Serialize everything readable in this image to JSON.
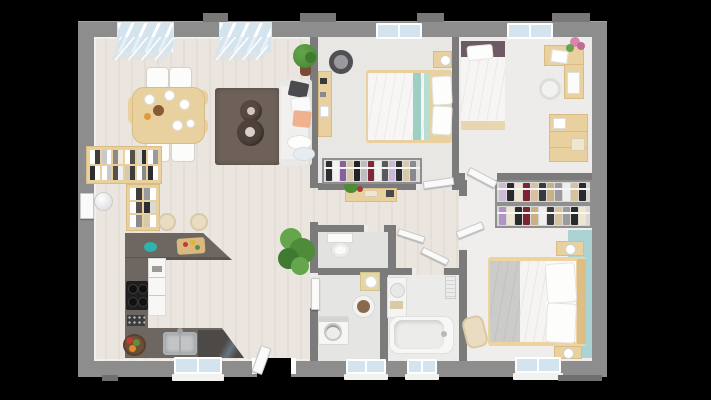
{
  "scene": {
    "type": "3d-floorplan-top-down-render",
    "background": "#000000",
    "has_text": false
  },
  "palette": {
    "wall": "#8d8d8d",
    "wall_inner": "#7b7b7b",
    "floor_a": "#eae5df",
    "floor_b": "#e4ded6",
    "b1_floor": "#e9e7e4",
    "b2_floor": "#edecea",
    "b3_floor": "#efeeec",
    "wc_floor": "#e2e2e0",
    "util_floor": "#e5e5e3",
    "bath_floor": "#ebebe9",
    "wood": "#e8d19e",
    "wood_dark": "#d9bc84",
    "counter": "#6e6660",
    "counter_dark": "#4d4946",
    "white_f": "#f7f7f5",
    "sofa": "#f1f0ee",
    "teal_wall": "#abd3d4",
    "teal_textile": "#9ecfc5",
    "rug": "#6d6159",
    "pouf": "#57493f",
    "glass": "#d3e4ee",
    "door": "#fafafa",
    "plant": "#4e8c3a",
    "plant_light": "#65a54b",
    "peach": "#efb18e",
    "mauve": "#6e5a64",
    "blanket": "#cbcbc9",
    "black_app": "#1f1f1f"
  },
  "rooms": [
    {
      "id": "living-dining-room",
      "furniture": [
        "dining-table",
        "dining-chairs",
        "area-rug",
        "round-poufs",
        "sofa",
        "potted-tree",
        "cube-bookshelf",
        "ball-floor-lamp"
      ]
    },
    {
      "id": "open-kitchen",
      "furniture": [
        "u-shaped-counter",
        "cooktop",
        "oven-column",
        "sink",
        "bar-stools",
        "cutting-board",
        "vegetable-basket"
      ]
    },
    {
      "id": "hallway",
      "furniture": [
        "console-table",
        "potted-plant"
      ]
    },
    {
      "id": "bedroom-1",
      "furniture": [
        "double-bed-teal",
        "desk",
        "round-chair",
        "nightstand-lamp",
        "open-wardrobe"
      ]
    },
    {
      "id": "bedroom-2",
      "furniture": [
        "single-bed",
        "corner-desk",
        "chair",
        "dresser",
        "flower-vase"
      ]
    },
    {
      "id": "bedroom-3",
      "furniture": [
        "double-bed",
        "two-nightstands",
        "double-clothes-rack",
        "armchair",
        "teal-accent-wall"
      ]
    },
    {
      "id": "wc",
      "furniture": [
        "toilet"
      ]
    },
    {
      "id": "utility-room",
      "furniture": [
        "washing-machine",
        "round-basin",
        "mini-vanity"
      ]
    },
    {
      "id": "bathroom",
      "furniture": [
        "bathtub",
        "vanity-unit",
        "radiator"
      ]
    }
  ],
  "openings": {
    "windows": [
      "living-bay-window-1",
      "living-bay-window-2",
      "bedroom1-window",
      "bedroom2-window",
      "kitchen-window",
      "utility-window",
      "bathroom-window",
      "bedroom3-window"
    ],
    "doors": [
      "entry-door-left",
      "terrace-door-bottom",
      "bedroom1-door",
      "bedroom2-door",
      "bedroom3-door",
      "wc-door",
      "bathroom-door",
      "utility-door"
    ]
  }
}
